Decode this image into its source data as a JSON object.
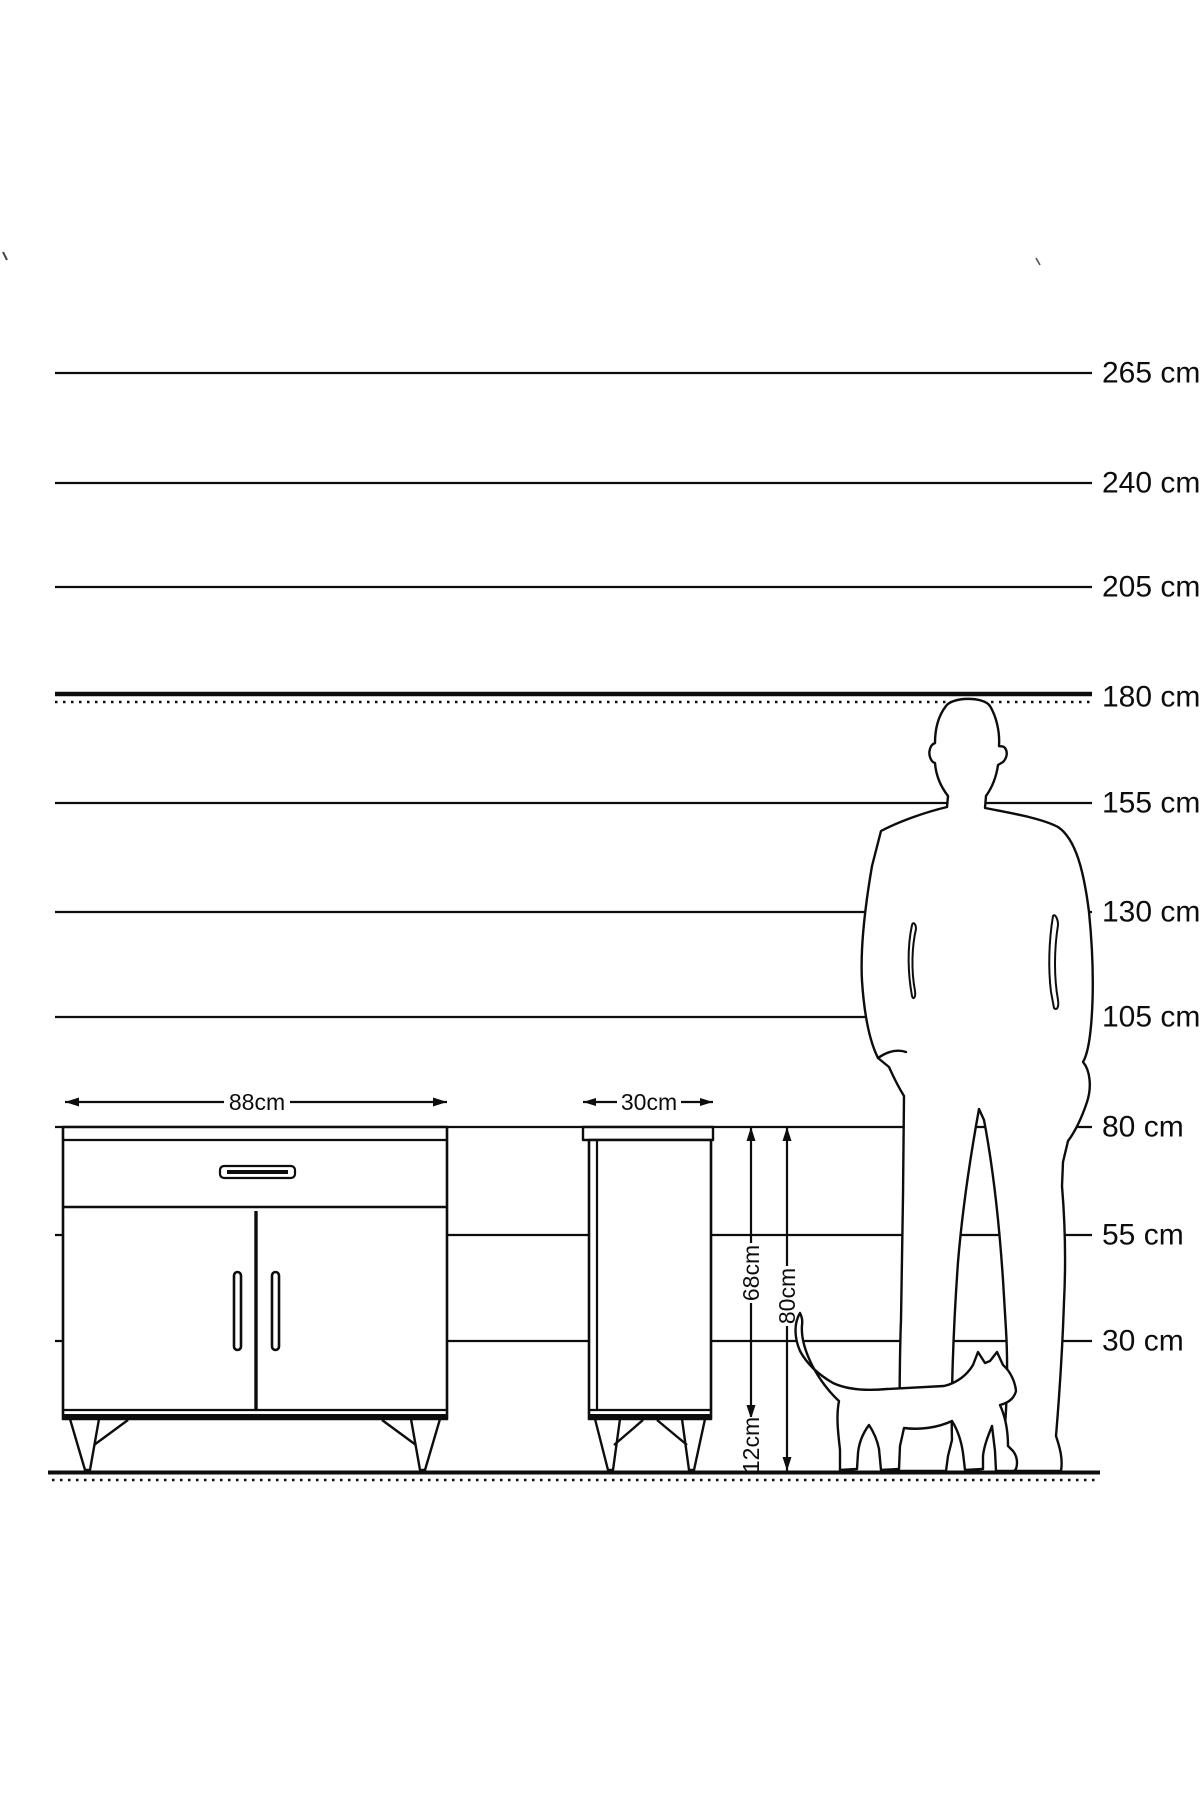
{
  "diagram": {
    "type": "furniture-size-comparison",
    "unit": "cm",
    "height_scale": {
      "values_cm": [
        265,
        240,
        205,
        180,
        155,
        130,
        105,
        80,
        55,
        30
      ],
      "labels": [
        "265 cm",
        "240 cm",
        "205 cm",
        "180 cm",
        "155 cm",
        "130 cm",
        "105 cm",
        "80 cm",
        "55 cm",
        "30 cm"
      ],
      "emphasized_value_cm": 180
    },
    "cabinet": {
      "front_view": {
        "width_label": "88cm"
      },
      "side_view": {
        "depth_label": "30cm"
      },
      "body_height_label": "68cm",
      "total_height_label": "80cm",
      "leg_height_label": "12cm"
    },
    "figures": [
      "man-silhouette",
      "cat-silhouette"
    ],
    "colors": {
      "line": "#0d0d0d",
      "background": "#ffffff"
    }
  }
}
